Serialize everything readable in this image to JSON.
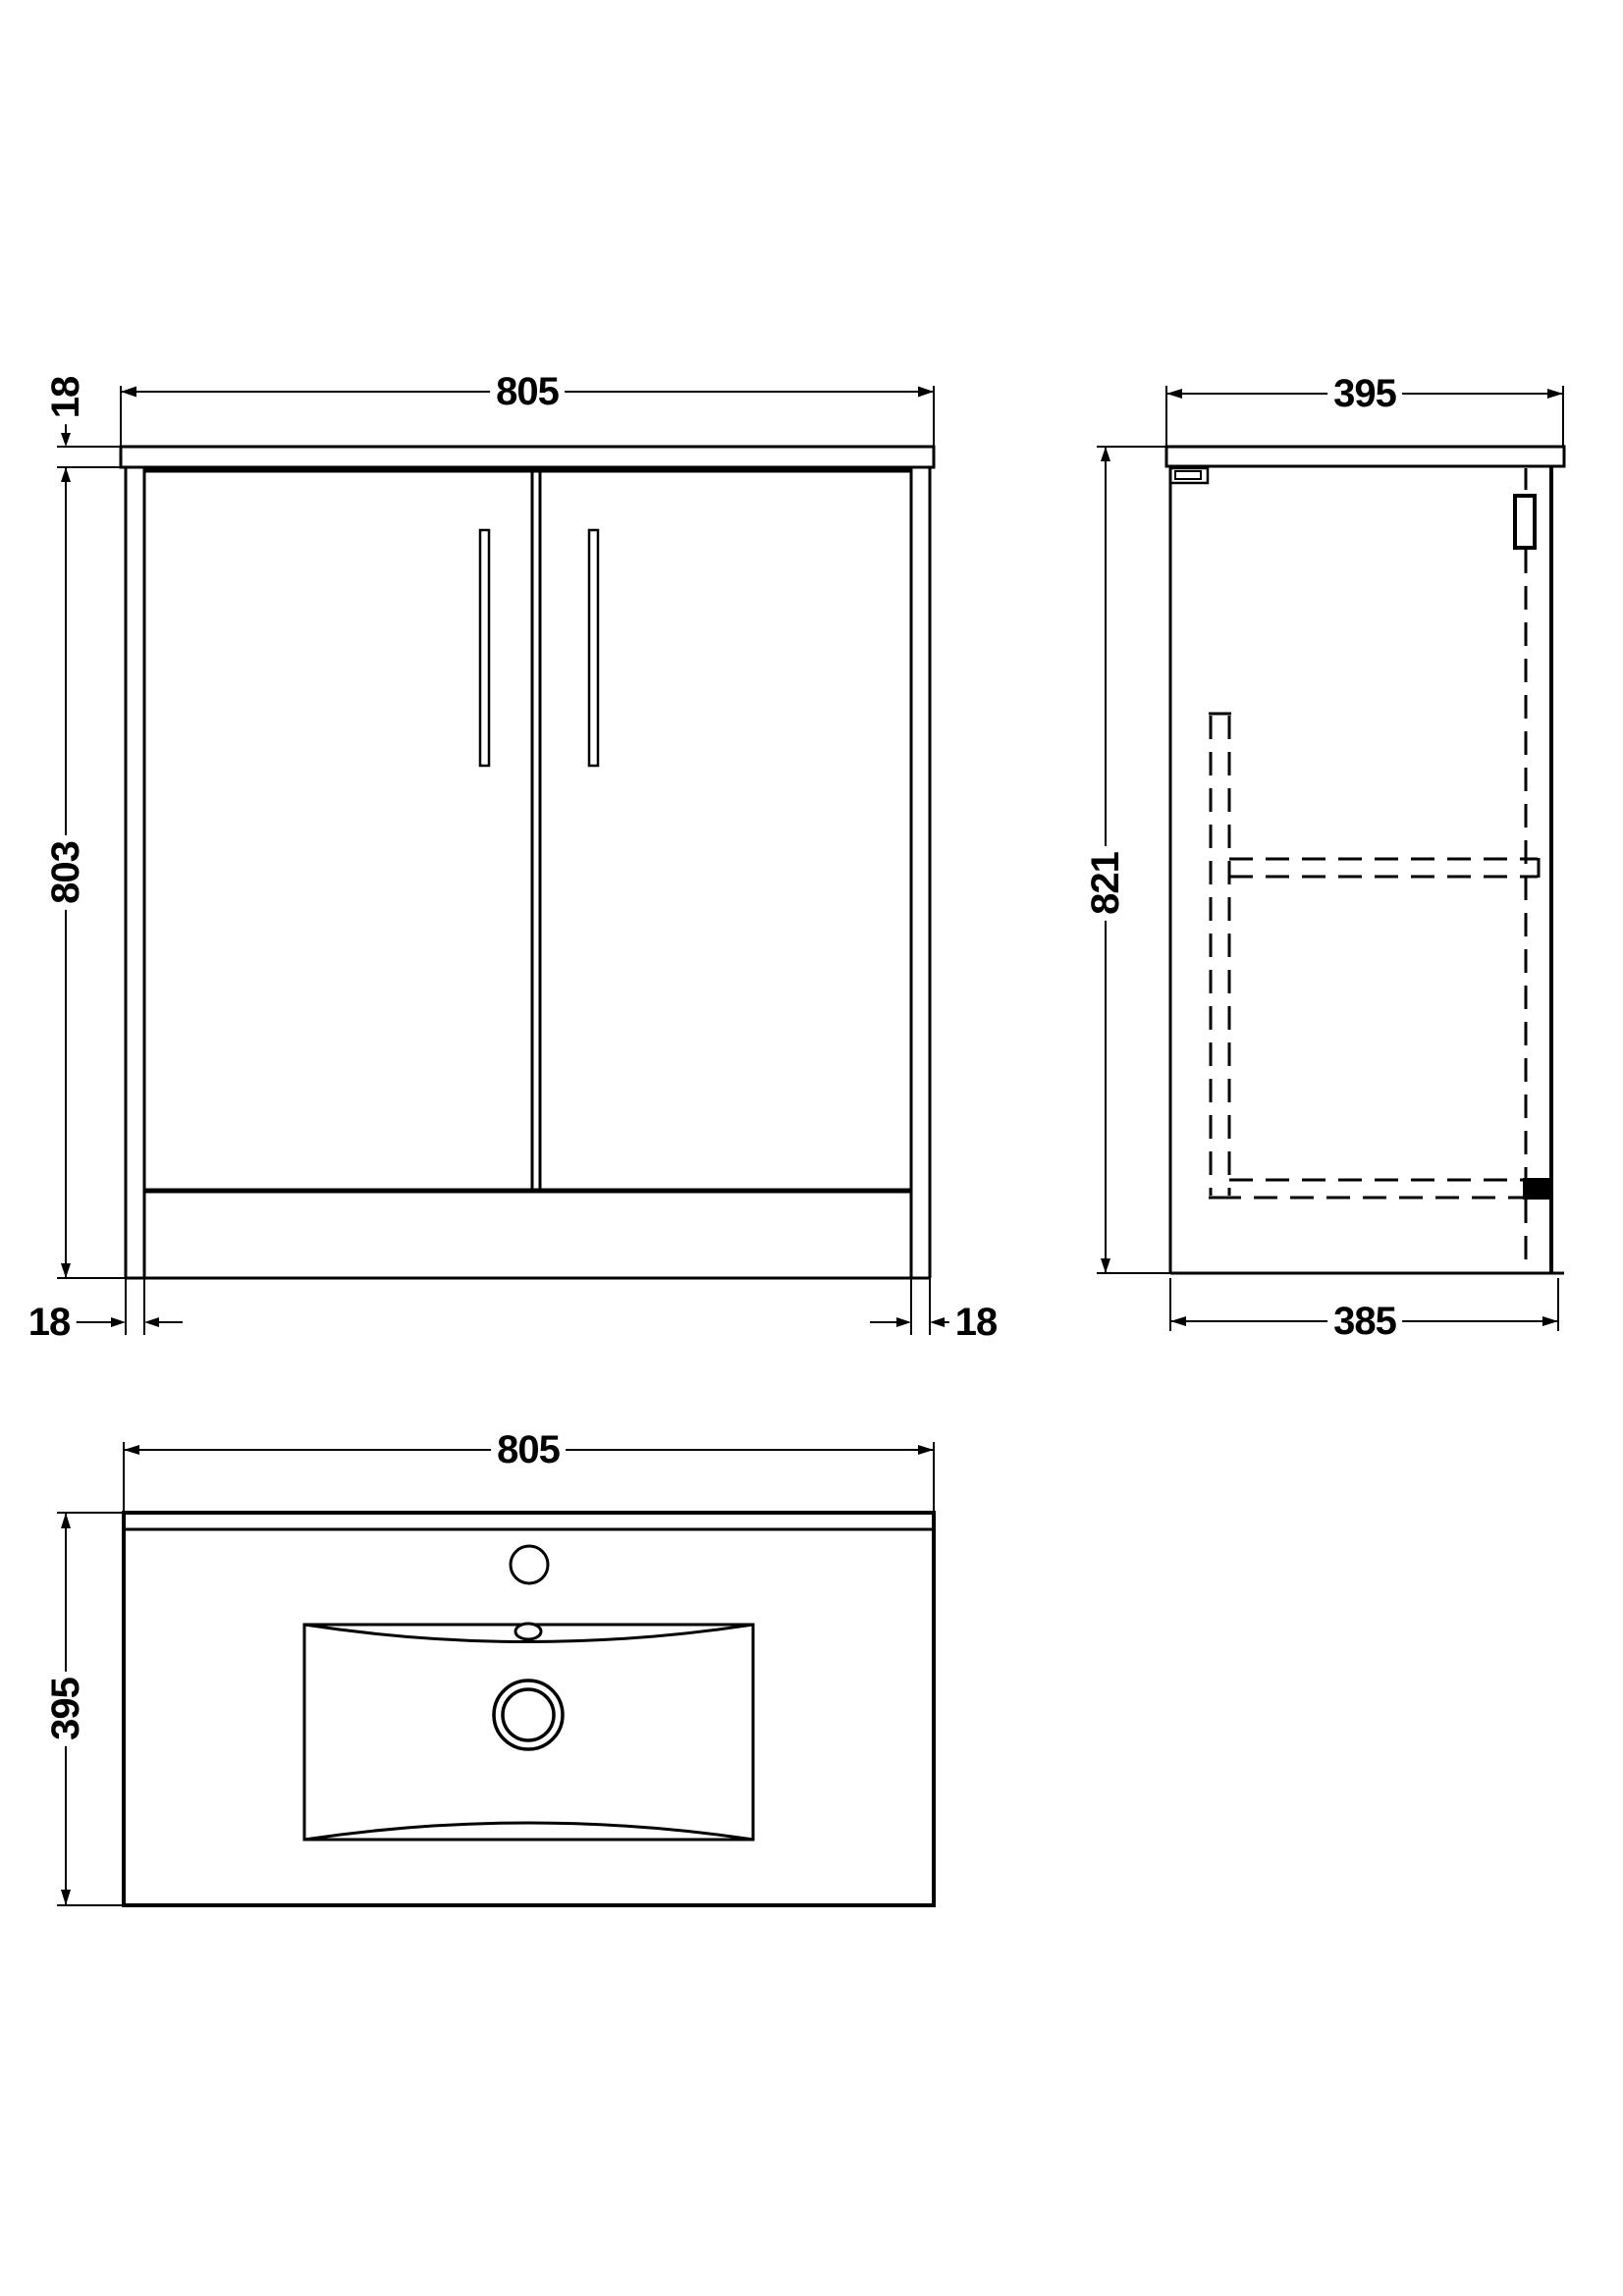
{
  "drawing": {
    "title": "Vanity unit with basin - dimensioned drawing",
    "front_view": {
      "width": "805",
      "worktop_thickness": "18",
      "height": "803",
      "left_panel_thickness": "18",
      "right_panel_thickness": "18"
    },
    "side_view": {
      "depth": "395",
      "height": "821",
      "carcass_depth": "385"
    },
    "plan_view": {
      "width": "805",
      "depth": "395"
    },
    "colors": {
      "line": "#000000",
      "background": "#ffffff"
    }
  }
}
